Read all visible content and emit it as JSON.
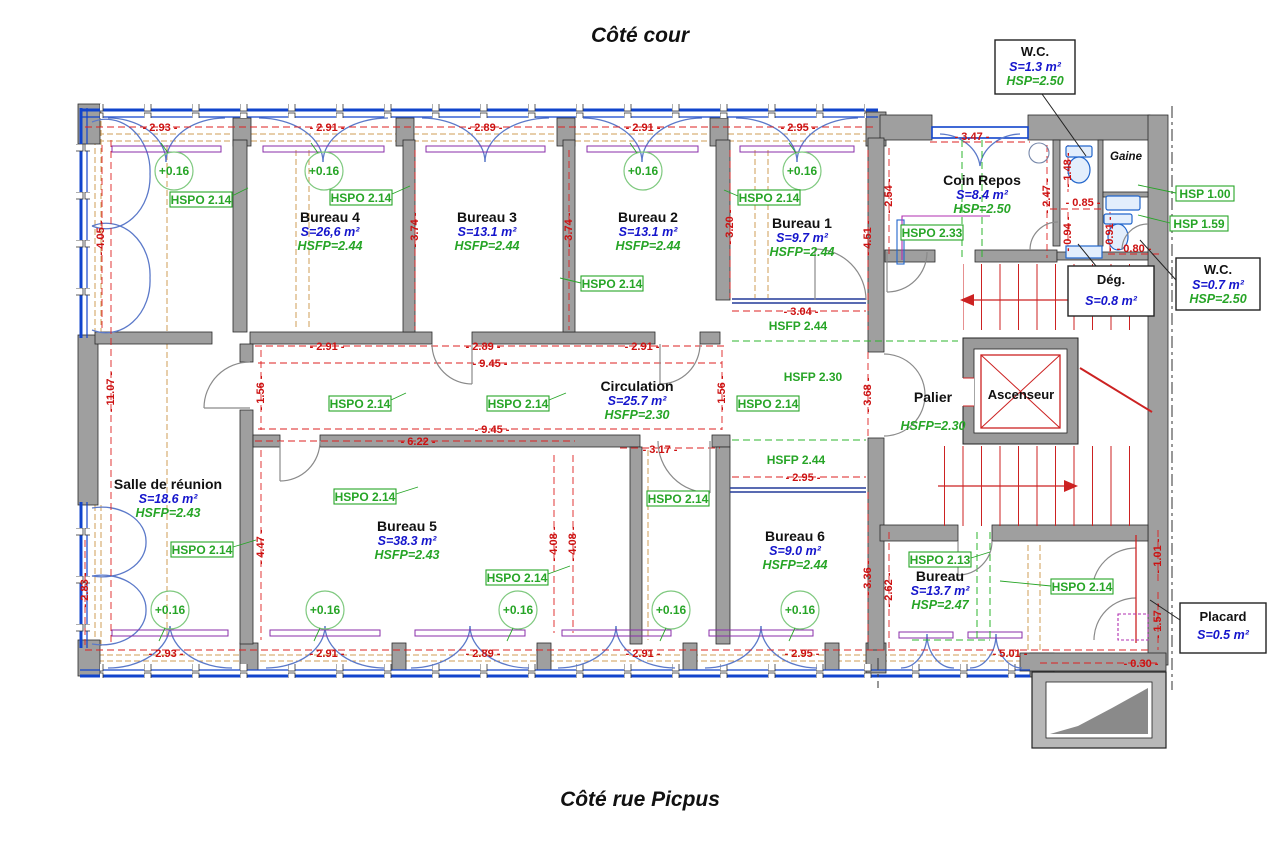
{
  "titles": {
    "top": "Côté cour",
    "bottom": "Côté rue Picpus"
  },
  "rooms": {
    "bureau4": {
      "name": "Bureau 4",
      "area": "S=26,6 m²",
      "height": "HSFP=2.44"
    },
    "bureau3": {
      "name": "Bureau 3",
      "area": "S=13.1 m²",
      "height": "HSFP=2.44"
    },
    "bureau2": {
      "name": "Bureau 2",
      "area": "S=13.1 m²",
      "height": "HSFP=2.44"
    },
    "bureau1": {
      "name": "Bureau 1",
      "area": "S=9.7 m²",
      "height": "HSFP=2.44"
    },
    "bureau5": {
      "name": "Bureau 5",
      "area": "S=38.3 m²",
      "height": "HSFP=2.43"
    },
    "bureau6": {
      "name": "Bureau 6",
      "area": "S=9.0 m²",
      "height": "HSFP=2.44"
    },
    "bureau_sud": {
      "name": "Bureau",
      "area": "S=13.7 m²",
      "height": "HSP=2.47"
    },
    "salle_reunion": {
      "name": "Salle de réunion",
      "area": "S=18.6 m²",
      "height": "HSFP=2.43"
    },
    "circulation": {
      "name": "Circulation",
      "area": "S=25.7 m²",
      "height": "HSFP=2.30"
    },
    "coin_repos": {
      "name": "Coin Repos",
      "area": "S=8.4 m²",
      "height": "HSP=2.50"
    },
    "palier": {
      "name": "Palier",
      "height": "HSFP=2.30"
    },
    "ascenseur": {
      "name": "Ascenseur"
    },
    "gaine": {
      "name": "Gaine"
    },
    "wc_haut": {
      "name": "W.C.",
      "area": "S=1.3 m²",
      "height": "HSP=2.50"
    },
    "wc_droit": {
      "name": "W.C.",
      "area": "S=0.7 m²",
      "height": "HSP=2.50"
    },
    "degagement": {
      "name": "Dég.",
      "area": "S=0.8 m²"
    },
    "placard": {
      "name": "Placard",
      "area": "S=0.5 m²"
    }
  },
  "annotations": {
    "hspo_214": "HSPO 2.14",
    "hspo_233": "HSPO 2.33",
    "hspo_213": "HSPO 2.13",
    "hsp_100": "HSP 1.00",
    "hsp_159": "HSP 1.59",
    "hsfp_244": "HSFP 2.44",
    "hsfp_230": "HSFP 2.30",
    "level": "+0.16"
  },
  "dims": {
    "d030": "- 0.30 -",
    "d080": "- 0.80 -",
    "d085": "- 0.85 -",
    "d091": "- 0.91 -",
    "d094": "- 0.94 -",
    "d101": "- 1.01 -",
    "d148": "- 1.48 -",
    "d156": "- 1.56 -",
    "d157": "- 1.57 -",
    "d247": "- 2.47 -",
    "d254": "- 2.54 -",
    "d262": "- 2.62 -",
    "d283": "- 2.83 -",
    "d289": "- 2.89 -",
    "d291": "- 2.91 -",
    "d293": "- 2.93 -",
    "d295": "- 2.95 -",
    "d304": "- 3.04 -",
    "d317": "- 3.17 -",
    "d320": "- 3.20 -",
    "d336": "- 3.36 -",
    "d347": "- 3.47 -",
    "d368": "- 3.68 -",
    "d374": "- 3.74 -",
    "d405": "- 4.05 -",
    "d408": "- 4.08 -",
    "d447": "- 4.47 -",
    "d451": "- 4.51 -",
    "d501": "- 5.01 -",
    "d622": "- 6.22 -",
    "d945": "- 9.45 -",
    "d1107": "- 11.07 -"
  },
  "colors": {
    "dimension_red": "#cc1111",
    "annotation_green": "#27a527",
    "area_blue": "#1515cc",
    "wall_gray": "#9f9f9f",
    "glazing_blue": "#1144cc",
    "soffit_tan": "#cf9d55",
    "stair_red": "#cc2222",
    "fixture_blue": "#2266cc",
    "magenta": "#b02fb0"
  }
}
